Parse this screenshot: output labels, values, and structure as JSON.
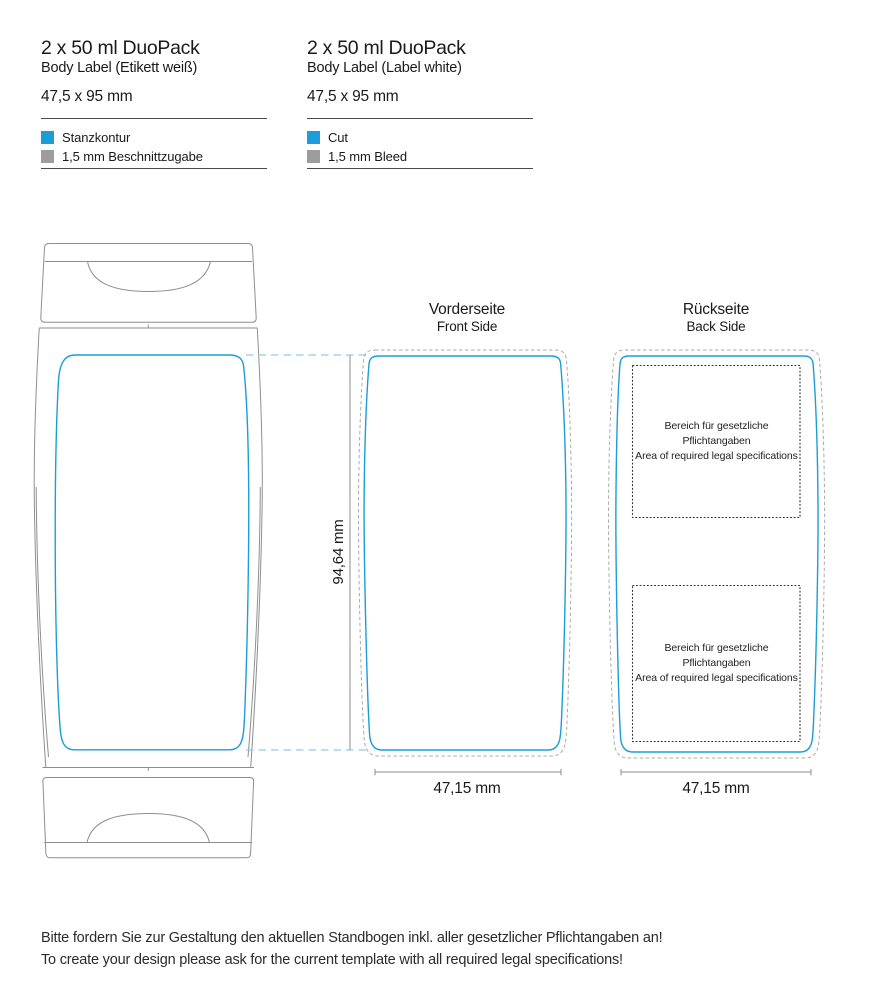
{
  "colors": {
    "cut": "#1B9DD9",
    "bleed": "#9D9D9C",
    "outline": "#8E8E8E",
    "bleed_outline": "#ABABAB",
    "connector": "#8FCDE9",
    "dimension": "#8C8C8C",
    "legal_box": "#2B2B2B"
  },
  "spec_blocks": [
    {
      "title": "2 x 50 ml DuoPack",
      "subtitle": "Body Label (Etikett weiß)",
      "dimensions": "47,5 x 95 mm",
      "legend": [
        {
          "label": "Stanzkontur"
        },
        {
          "label": "1,5 mm Beschnittzugabe"
        }
      ]
    },
    {
      "title": "2 x 50 ml DuoPack",
      "subtitle": "Body Label (Label white)",
      "dimensions": "47,5 x 95 mm",
      "legend": [
        {
          "label": "Cut"
        },
        {
          "label": "1,5 mm Bleed"
        }
      ]
    }
  ],
  "sections": {
    "front": {
      "title": "Vorderseite",
      "subtitle": "Front Side",
      "width_label": "47,15 mm"
    },
    "back": {
      "title": "Rückseite",
      "subtitle": "Back Side",
      "width_label": "47,15 mm"
    },
    "height_label": "94,64 mm"
  },
  "legal_boxes": [
    {
      "line_de": "Bereich für gesetzliche Pflichtangaben",
      "line_en": "Area of required legal specifications"
    },
    {
      "line_de": "Bereich für gesetzliche Pflichtangaben",
      "line_en": "Area of required legal specifications"
    }
  ],
  "footer": {
    "line_de": "Bitte fordern Sie zur Gestaltung den aktuellen Standbogen inkl. aller gesetzlicher Pflichtangaben an!",
    "line_en": "To create your design please ask for the current template with all required legal specifications!"
  }
}
